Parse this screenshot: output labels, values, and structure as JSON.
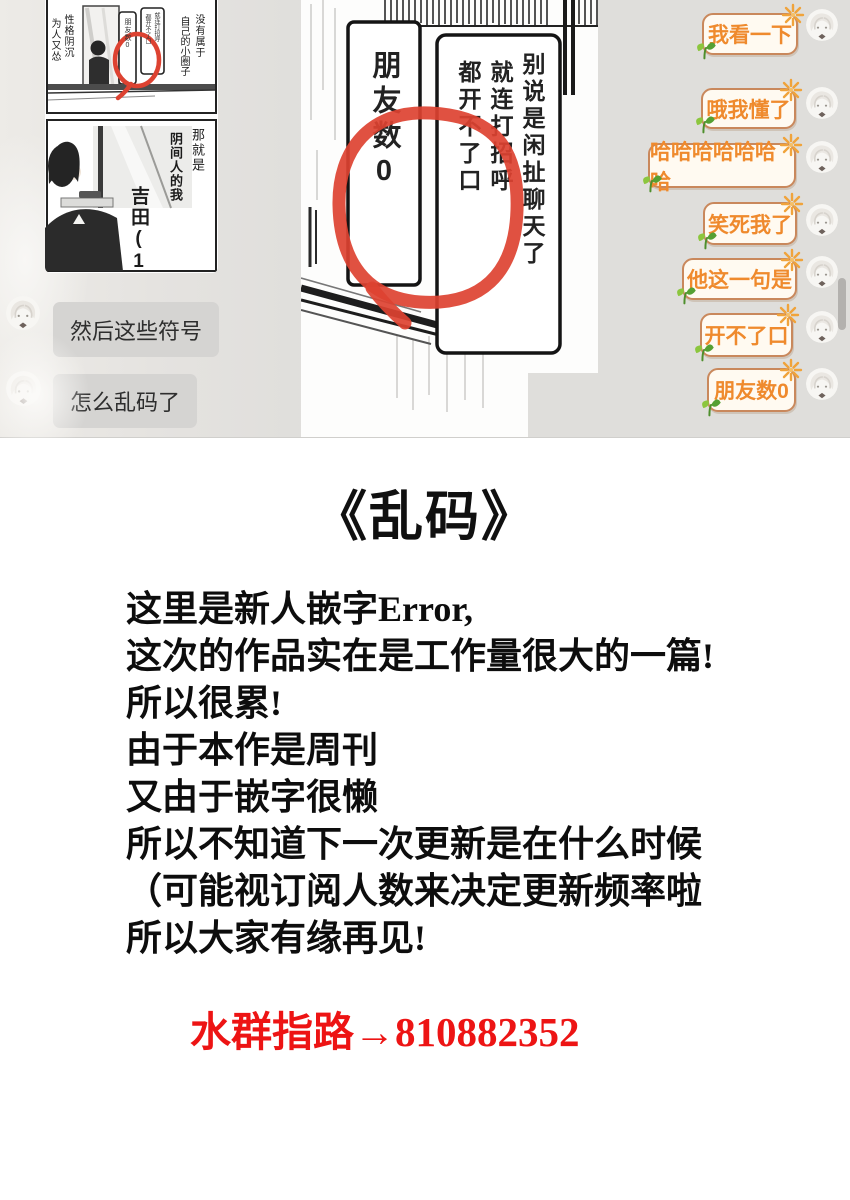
{
  "chat": {
    "left_messages": [
      "然后这些符号",
      "怎么乱码了"
    ],
    "right_messages": [
      "我看一下",
      "哦我懂了",
      "哈哈哈哈哈哈哈",
      "笑死我了",
      "他这一句是",
      "开不了口",
      "朋友数0"
    ],
    "thumbnail": {
      "panel1": {
        "left_col1": "性格阴沉",
        "left_col2": "为人又怂",
        "right_col1": "没有属于",
        "right_col2": "自己的小圈子",
        "bubble_small_left": "朋友数0",
        "bubble_small_right1": "就连打招呼",
        "bubble_small_right2": "都开不了口"
      },
      "panel2": {
        "col1": "那就是",
        "col2": "阴间人的我",
        "name": "吉田(14)"
      }
    },
    "big_image": {
      "bubble_left": "朋友数0",
      "bubble_right_col1": "别说是闲扯聊天了",
      "bubble_right_col2": "就连打招呼",
      "bubble_right_col3": "都开不了口"
    }
  },
  "credits": {
    "title": "《乱码》",
    "lines": [
      "这里是新人嵌字Error,",
      "这次的作品实在是工作量很大的一篇!",
      "所以很累!",
      "由于本作是周刊",
      "又由于嵌字很懒",
      "所以不知道下一次更新是在什么时候",
      "（可能视订阅人数来决定更新频率啦",
      "所以大家有缘再见!"
    ],
    "qq_line": "水群指路→810882352"
  },
  "icons": {
    "sparkle_icon": "orange starburst ✺",
    "sprout_icon": "green seedling leaves",
    "avatar_icon": "round anime avatar"
  },
  "colors": {
    "chat_bg": "#dfdedb",
    "left_bubble_bg": "#d5d4d2",
    "right_bubble_bg": "#fffaf1",
    "right_bubble_border": "#c9885c",
    "right_bubble_text": "#ef8a2d",
    "annotation_red": "#dd4231",
    "footer_red": "#ed1414",
    "manga_ink": "#1a1a1a"
  }
}
